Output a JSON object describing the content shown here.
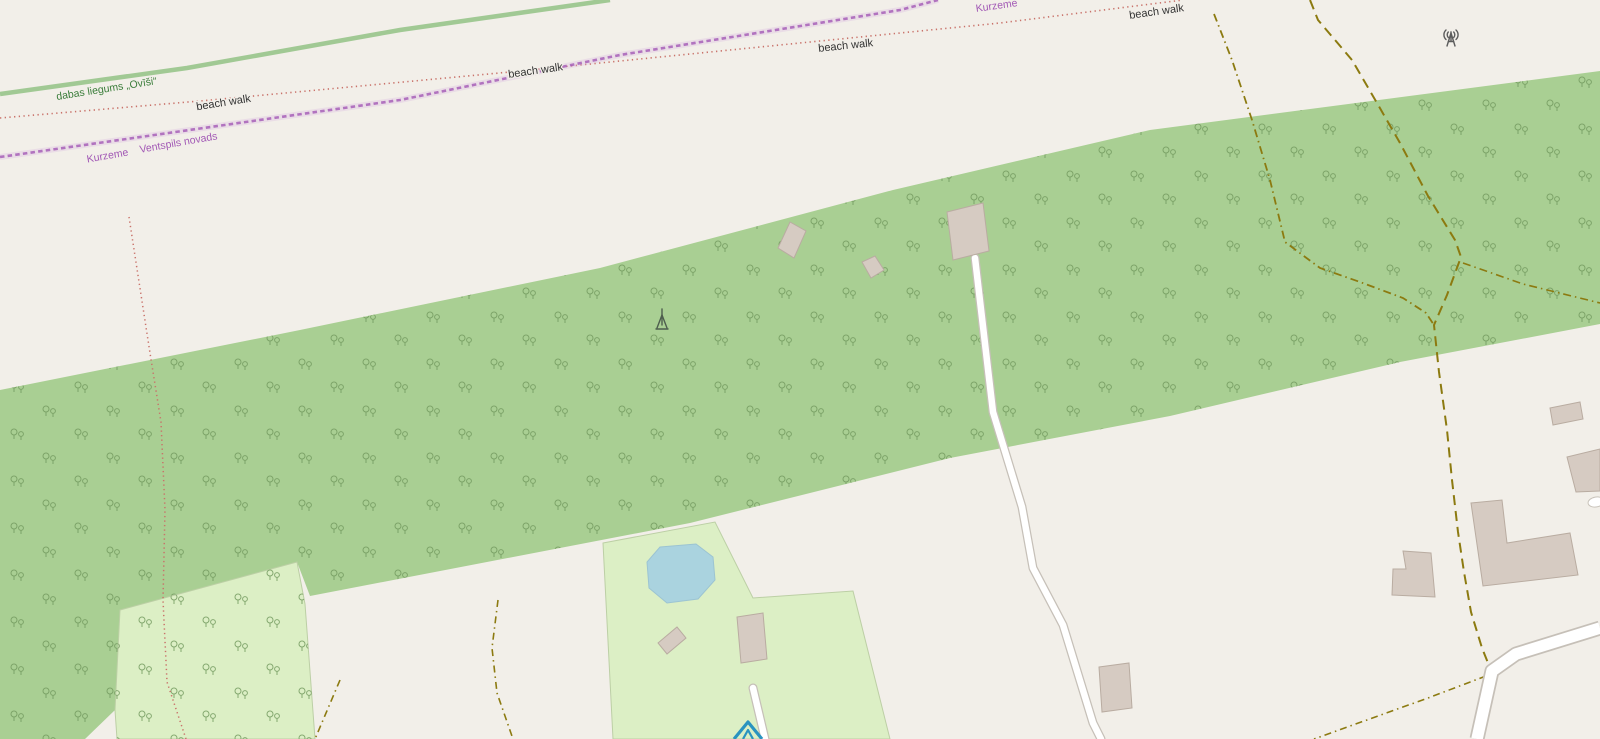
{
  "map": {
    "description": "OpenStreetMap-style map of a Latvian coastal strip with forest band, beach walk paths and scattered farm buildings",
    "labels": {
      "nature_reserve": "dabas liegums „Ovīši“",
      "beach_walk": "beach walk",
      "region": "Kurzeme",
      "municipality": "Ventspils novads"
    },
    "icons": {
      "communications_tower": "communications-tower-icon",
      "mast": "mast-icon",
      "campsite": "campsite-icon"
    },
    "colors": {
      "land": "#f2efe9",
      "forest": "#a9cf93",
      "forest_tree_glyph": "#749b60",
      "grass": "#dcefc5",
      "water": "#aad3df",
      "building_fill": "#d6cbc2",
      "building_stroke": "#b9aca1",
      "road_fill": "#ffffff",
      "road_casing": "#c6c0b8",
      "track": "#8c7a10",
      "admin_boundary": "#a259b5",
      "trail_dots": "#c9726a",
      "reserve_border": "#8cbf7e",
      "reserve_label": "#3a7d3a",
      "path_label": "#333333",
      "campsite_icon": "#2a93c0",
      "tower_icon": "#5b5b5b",
      "mast_icon": "#4e5e4e"
    }
  }
}
